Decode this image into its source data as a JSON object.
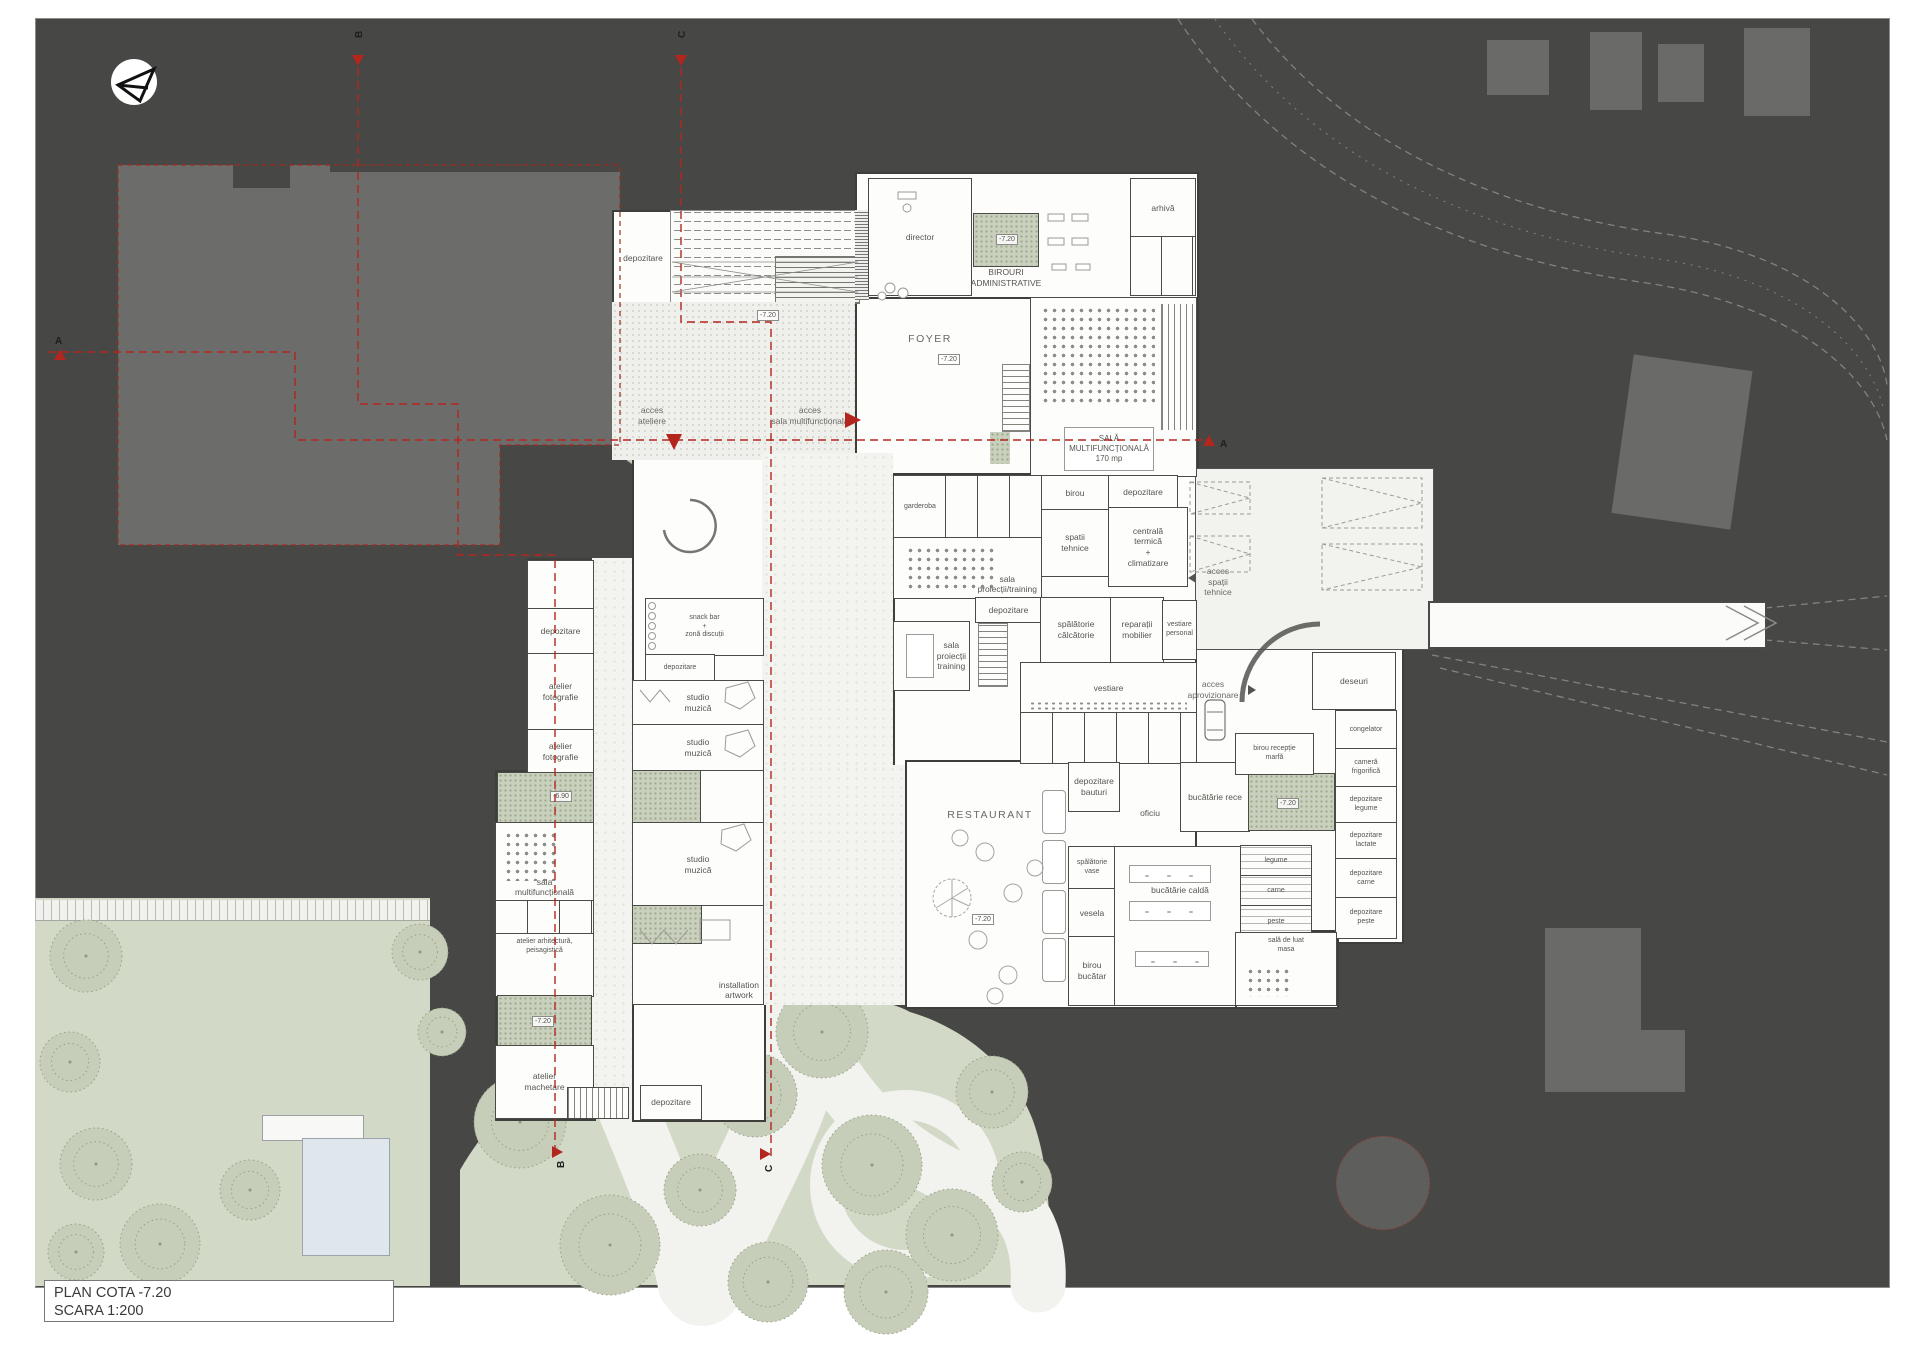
{
  "title_block": {
    "line1": "PLAN COTA -7.20",
    "line2": "SCARA 1:200"
  },
  "section_markers": {
    "a": "A",
    "b": "B",
    "c": "C"
  },
  "levels": {
    "plaza": "-7.20",
    "foyer": "-7.20",
    "admin_court": "-7.20",
    "restaurant": "-7.20",
    "kitchen_court": "-7.20",
    "west_court_1": "-6.90",
    "west_court_2": "-7.20"
  },
  "annotations": {
    "acces_ateliere": "acces\nateliere",
    "acces_sala": "acces\nsala multifunctionala",
    "acces_tehnice": "acces\nspații\ntehnice",
    "acces_aprovizionare": "acces\naprovizionare"
  },
  "rooms": {
    "dep_canopy": {
      "label": "depozitare"
    },
    "director": {
      "label": "director"
    },
    "birouri_admin": {
      "label": "BIROURI\nADMINISTRATIVE"
    },
    "arhiva": {
      "label": "arhivă"
    },
    "foyer": {
      "label": "FOYER"
    },
    "sala_multi": {
      "label": "SALĂ\nMULTIFUNCȚIONALĂ\n170 mp"
    },
    "birou": {
      "label": "birou"
    },
    "dep_scena": {
      "label": "depozitare"
    },
    "spatii_tehnice": {
      "label": "spatii\ntehnice"
    },
    "centrala": {
      "label": "centrală\ntermică\n+\nclimatizare"
    },
    "garderoba": {
      "label": "garderoba"
    },
    "sala_proiectii": {
      "label": "sala\nproiecții/training"
    },
    "dep_mid": {
      "label": "depozitare"
    },
    "spalatorie_calcatorie": {
      "label": "spălătorie\ncălcătorie"
    },
    "reparatii_mobilier": {
      "label": "reparații\nmobilier"
    },
    "vestiare_personal": {
      "label": "vestiare\npersonal"
    },
    "sala_training": {
      "label": "sala\nproiecții\ntraining"
    },
    "vestiare": {
      "label": "vestiare"
    },
    "deseuri": {
      "label": "deseuri"
    },
    "congelator": {
      "label": "congelator"
    },
    "camera_frigorifica": {
      "label": "cameră\nfrigorifică"
    },
    "dep_legume": {
      "label": "depozitare\nlegume"
    },
    "dep_lactate": {
      "label": "depozitare\nlactate"
    },
    "dep_carne": {
      "label": "depozitare\ncarne"
    },
    "dep_peste": {
      "label": "depozitare\npește"
    },
    "legume": {
      "label": "legume"
    },
    "carne": {
      "label": "carne"
    },
    "peste": {
      "label": "peste"
    },
    "birou_receptie": {
      "label": "birou recepție\nmarfă"
    },
    "bucatarie_rece": {
      "label": "bucătărie rece"
    },
    "oficiu": {
      "label": "oficiu"
    },
    "dep_bauturi": {
      "label": "depozitare\nbauturi"
    },
    "restaurant": {
      "label": "RESTAURANT"
    },
    "spalatorie_vase": {
      "label": "spălătorie\nvase"
    },
    "vesela": {
      "label": "vesela"
    },
    "bucatarie_calda": {
      "label": "bucătărie caldă"
    },
    "birou_bucatar": {
      "label": "birou\nbucătar"
    },
    "sala_masa": {
      "label": "sală de luat\nmasa"
    },
    "snack_bar": {
      "label": "snack bar\n+\nzonă discuții"
    },
    "dep_snack": {
      "label": "depozitare"
    },
    "studio1": {
      "label": "studio\nmuzică"
    },
    "studio2": {
      "label": "studio\nmuzică"
    },
    "studio3": {
      "label": "studio\nmuzică"
    },
    "dep_west": {
      "label": "depozitare"
    },
    "atelier_foto1": {
      "label": "atelier\nfotografie"
    },
    "atelier_foto2": {
      "label": "atelier\nfotografie"
    },
    "sala_multi_west": {
      "label": "sala\nmultifuncțională"
    },
    "atelier_arhitectura": {
      "label": "atelier arhitectură,\npeisagistică"
    },
    "installation": {
      "label": "installation\nartwork"
    },
    "atelier_machetare": {
      "label": "atelier\nmachetare"
    },
    "dep_jos": {
      "label": "depozitare"
    }
  }
}
